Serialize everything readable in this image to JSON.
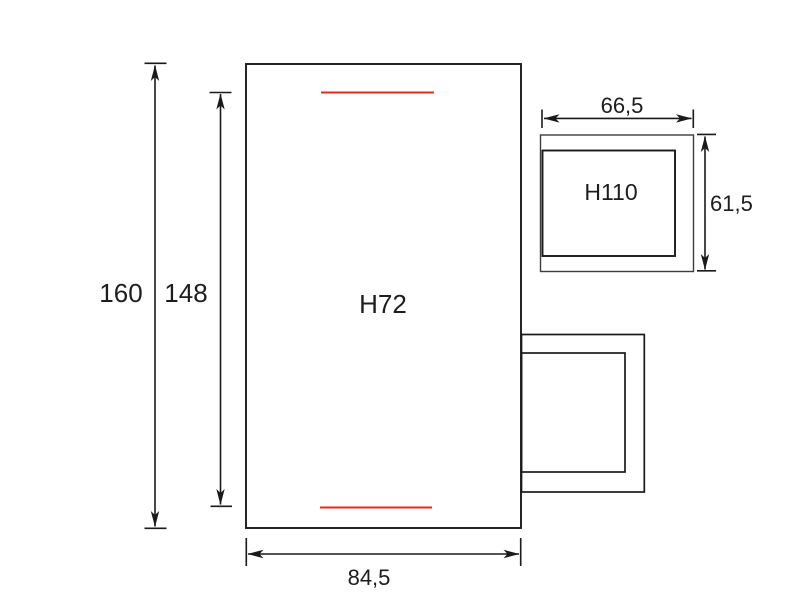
{
  "canvas": {
    "background": "#ffffff",
    "ink": "#1a1a1a",
    "ink_light": "#3d3d3d",
    "red_marker": "#e62b1e"
  },
  "main_enclosure": {
    "label": "H72"
  },
  "small_enclosure": {
    "label": "H110"
  },
  "dimensions": {
    "overall_height": "160",
    "red_span_height": "148",
    "overall_width": "84,5",
    "small_enclosure_width": "66,5",
    "small_enclosure_height": "61,5"
  }
}
